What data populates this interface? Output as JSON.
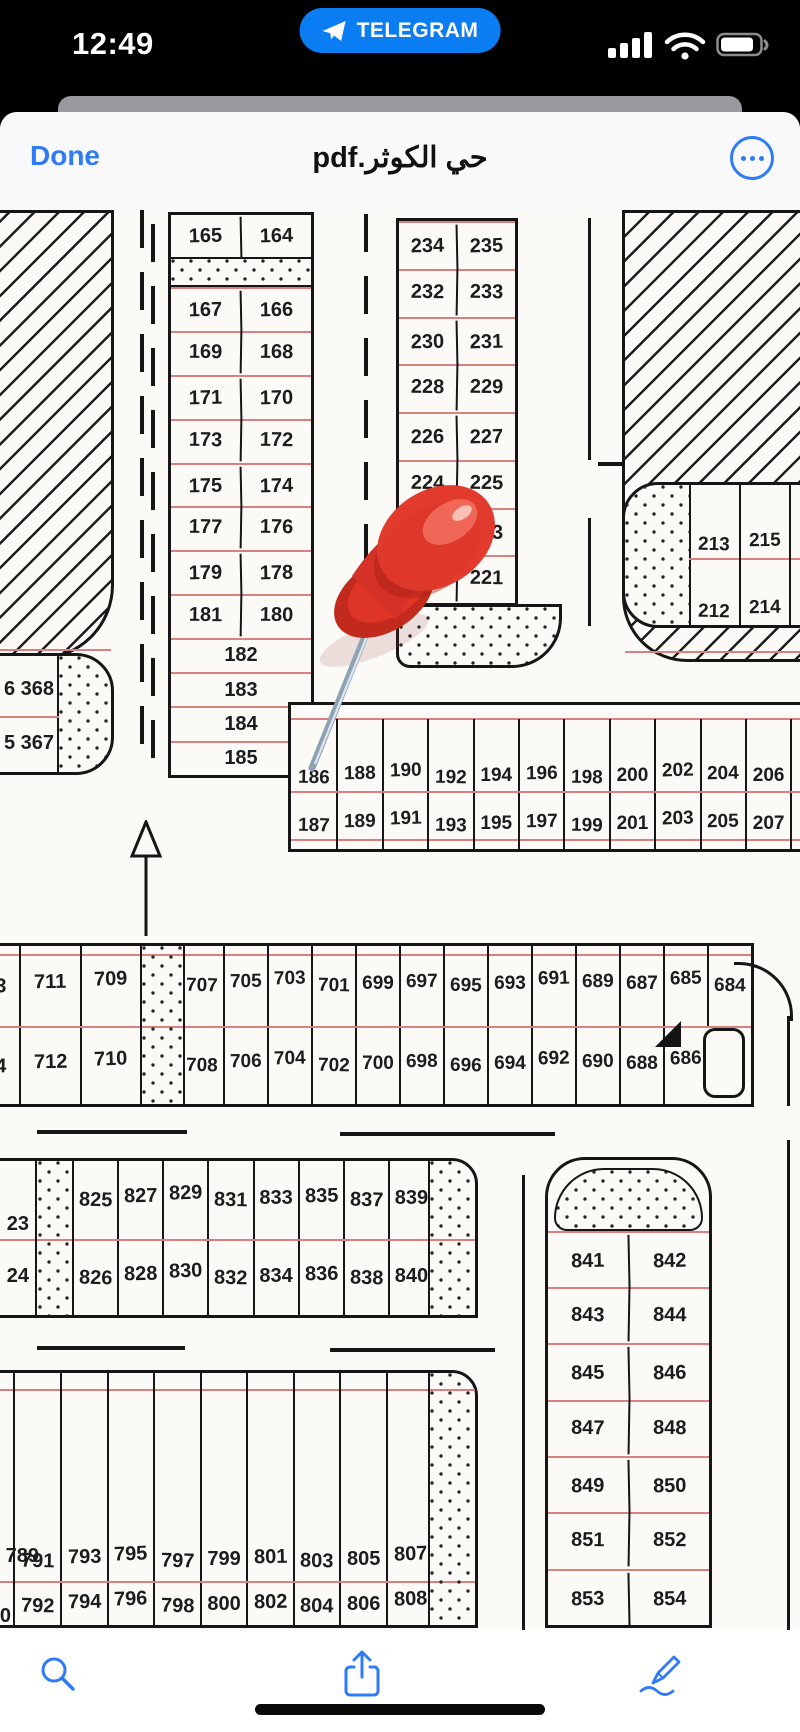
{
  "status_bar": {
    "time": "12:49",
    "carrier_banner": "TELEGRAM"
  },
  "nav_bar": {
    "done_label": "Done",
    "title": "حي الكوثر.pdf"
  },
  "colors": {
    "accent": "#2f7bf5",
    "banner_blue": "#0b7df2",
    "map_line": "#161616",
    "map_red_line": "#d98080",
    "pin_red": "#e23a2c"
  },
  "map": {
    "col_left": {
      "top_pair": [
        "165",
        "164"
      ],
      "pair_rows": [
        [
          "167",
          "166"
        ],
        [
          "169",
          "168"
        ],
        [
          "171",
          "170"
        ],
        [
          "173",
          "172"
        ],
        [
          "175",
          "174"
        ],
        [
          "177",
          "176"
        ],
        [
          "179",
          "178"
        ],
        [
          "181",
          "180"
        ]
      ],
      "single_rows": [
        "182",
        "183",
        "184",
        "185"
      ]
    },
    "col_mid": {
      "pair_rows": [
        [
          "234",
          "235"
        ],
        [
          "232",
          "233"
        ],
        [
          "230",
          "231"
        ],
        [
          "228",
          "229"
        ],
        [
          "226",
          "227"
        ],
        [
          "224",
          "225"
        ],
        [
          "222",
          "223"
        ],
        [
          "220",
          "221"
        ]
      ]
    },
    "block_213": {
      "top": [
        "213",
        "215",
        "2"
      ],
      "bottom": [
        "212",
        "214",
        "21"
      ]
    },
    "block_368": {
      "top": "6 368",
      "bottom": "5 367"
    },
    "row_186": {
      "top": [
        "186",
        "188",
        "190",
        "192",
        "194",
        "196",
        "198",
        "200",
        "202",
        "204",
        "206",
        "2"
      ],
      "bottom": [
        "187",
        "189",
        "191",
        "193",
        "195",
        "197",
        "199",
        "201",
        "203",
        "205",
        "207",
        "2"
      ]
    },
    "band_700": {
      "left_top": [
        "713",
        "711",
        "709"
      ],
      "left_bottom": [
        "714",
        "712",
        "710"
      ],
      "right_top": [
        "707",
        "705",
        "703",
        "701",
        "699",
        "697",
        "695",
        "693",
        "691",
        "689",
        "687",
        "685",
        "684"
      ],
      "right_bottom": [
        "708",
        "706",
        "704",
        "702",
        "700",
        "698",
        "696",
        "694",
        "692",
        "690",
        "688",
        "686"
      ]
    },
    "block_820": {
      "left_top": "23",
      "left_bottom": "24",
      "top": [
        "825",
        "827",
        "829",
        "831",
        "833",
        "835",
        "837",
        "839"
      ],
      "bottom": [
        "826",
        "828",
        "830",
        "832",
        "834",
        "836",
        "838",
        "840"
      ]
    },
    "block_840": {
      "pair_rows": [
        [
          "841",
          "842"
        ],
        [
          "843",
          "844"
        ],
        [
          "845",
          "846"
        ],
        [
          "847",
          "848"
        ],
        [
          "849",
          "850"
        ],
        [
          "851",
          "852"
        ],
        [
          "853",
          "854"
        ]
      ]
    },
    "block_790": {
      "left_top": "789",
      "left_bottom": "790",
      "top": [
        "791",
        "793",
        "795",
        "797",
        "799",
        "801",
        "803",
        "805",
        "807"
      ],
      "bottom": [
        "792",
        "794",
        "796",
        "798",
        "800",
        "802",
        "804",
        "806",
        "808"
      ]
    }
  }
}
